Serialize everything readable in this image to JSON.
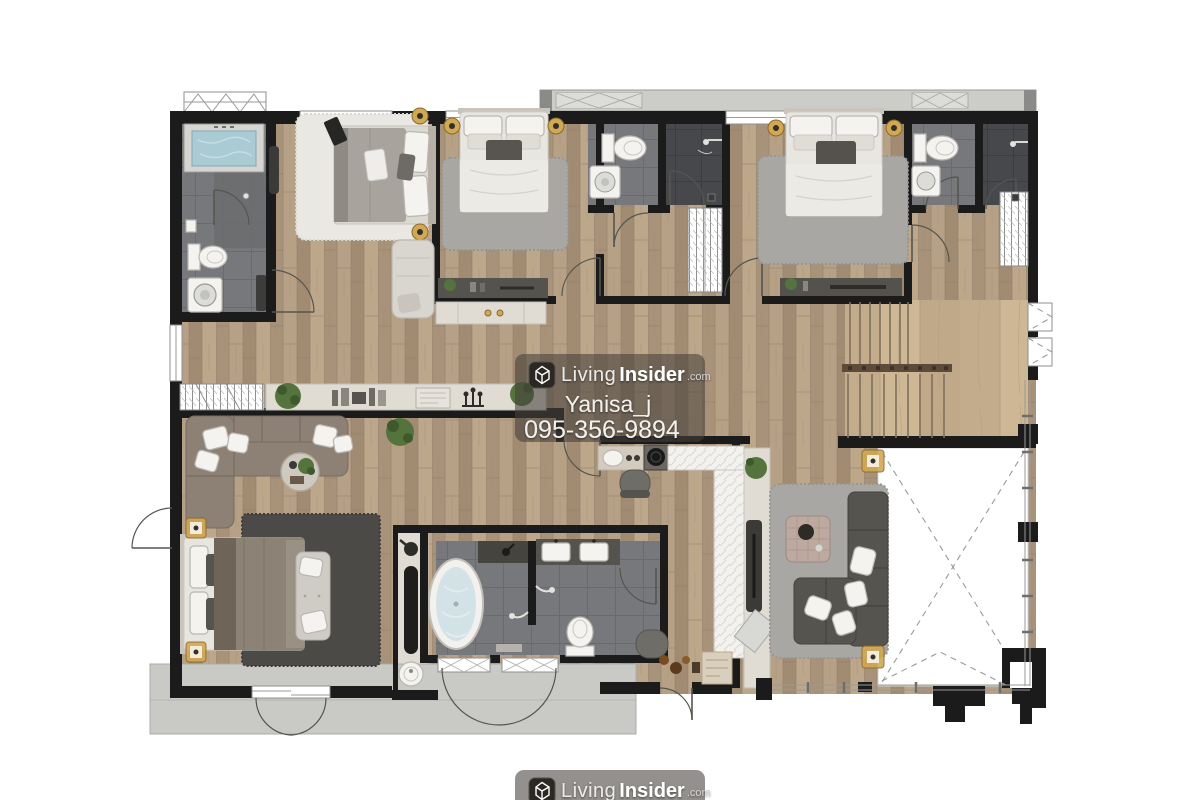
{
  "watermark": {
    "brand_light": "Living",
    "brand_bold": "Insider",
    "brand_suffix": ".com",
    "username": "Yanisa_j",
    "phone": "095-356-9894",
    "logo_icon": "livinginsider-house-cube"
  },
  "colors": {
    "wall": "#1b1b1b",
    "wood": "#b09a7f",
    "wood_light": "#c7b192",
    "tile": "#77787b",
    "tile_dark": "#47484b",
    "pool": "#a9cbd3",
    "terrace": "#c9c9c6",
    "marble": "#e0dcd4",
    "rug_white": "#eae8e3",
    "rug_gray": "#a9a7a4",
    "rug_dark": "#4b4a47",
    "sofa_dark": "#56544f",
    "sofa_taupe": "#8d8175",
    "bed_linen": "#e8e6e1",
    "gold": "#d2a854",
    "void_line": "#9a9a98"
  },
  "fixtures": [
    "swimming-pool",
    "bathtub",
    "toilets",
    "double-vanity-sinks",
    "washing-machines",
    "showers",
    "beds",
    "wardrobes",
    "sofas",
    "coffee-tables",
    "tv-consoles",
    "kitchen-counter",
    "bar-stools",
    "staircase",
    "rugs",
    "plants",
    "terrace",
    "double-height-void"
  ]
}
